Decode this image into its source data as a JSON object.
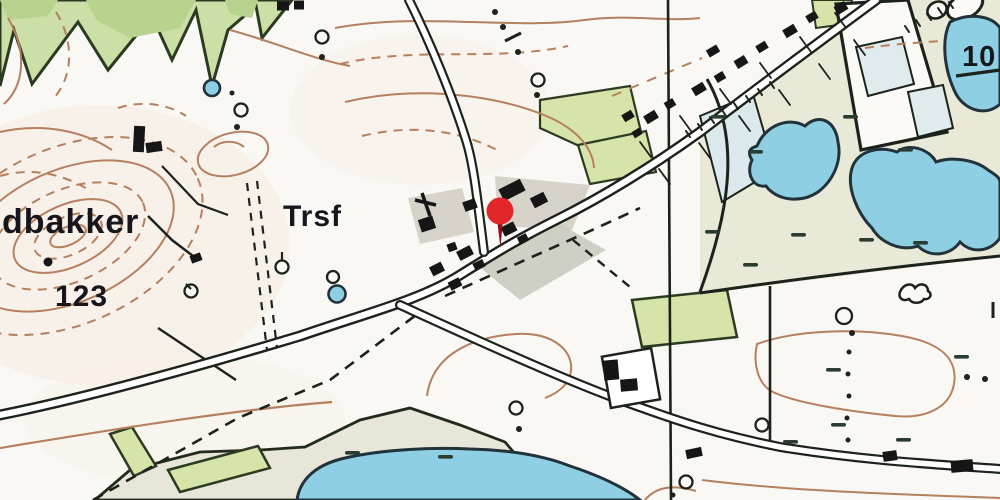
{
  "map": {
    "type": "topographic-map-with-location-pin",
    "labels": {
      "place_name_partial": "dbakker",
      "transformer_abbrev": "Trsf",
      "spot_elevation": "123",
      "spot_elevation_partial": "10"
    },
    "marker": {
      "kind": "location-pin",
      "head_color": "#e2262b",
      "stem_color": "#8f1115"
    },
    "palette": {
      "paper": "#faf8f4",
      "forest_green": "#cbdfa6",
      "forest_green_dark": "#b7d38e",
      "field_green": "#d6e4a9",
      "meadow_beige": "#e9e9d8",
      "bog_beige": "#e8e6d9",
      "water_blue": "#8fcfe4",
      "pale_blue_field": "#dfeaec",
      "contour_brown": "#b5805e",
      "ink": "#1d201c",
      "yard_gray": "#d8d3ca"
    }
  }
}
